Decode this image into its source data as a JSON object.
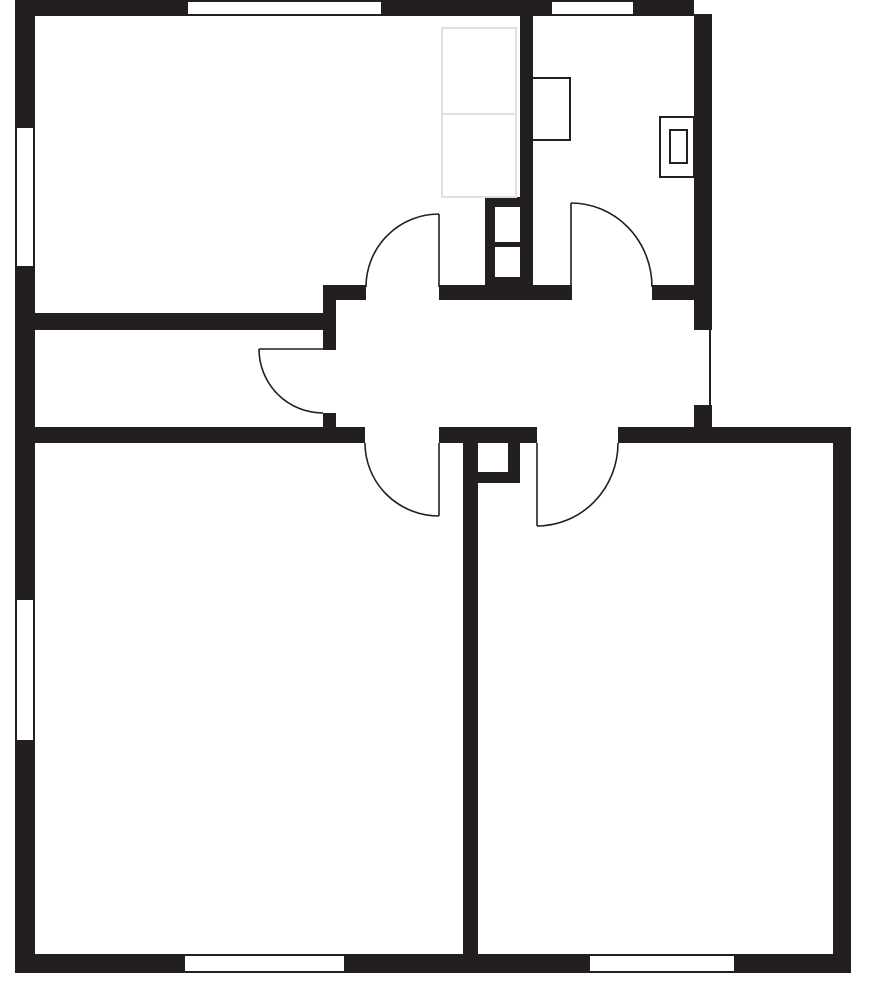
{
  "floor_plan": {
    "canvas": {
      "width": 888,
      "height": 1004,
      "background": "#ffffff"
    },
    "colors": {
      "wall": "#231f20",
      "line": "#231f20",
      "faint_furniture": "#e0e0e0",
      "floor": "#ffffff"
    },
    "walls": [
      {
        "name": "exterior-top-wall-left",
        "x": 15,
        "y": 0,
        "w": 173,
        "h": 16
      },
      {
        "name": "exterior-top-wall-middle",
        "x": 381,
        "y": 0,
        "w": 171,
        "h": 16
      },
      {
        "name": "exterior-top-wall-right",
        "x": 633,
        "y": 0,
        "w": 61,
        "h": 16
      },
      {
        "name": "exterior-left-wall-upper",
        "x": 15,
        "y": 0,
        "w": 20,
        "h": 128
      },
      {
        "name": "exterior-left-wall-middle",
        "x": 15,
        "y": 266,
        "w": 20,
        "h": 334
      },
      {
        "name": "exterior-left-wall-lower",
        "x": 15,
        "y": 740,
        "w": 20,
        "h": 233
      },
      {
        "name": "exterior-bottom-wall-left",
        "x": 15,
        "y": 954,
        "w": 170,
        "h": 19
      },
      {
        "name": "exterior-bottom-wall-middle",
        "x": 344,
        "y": 954,
        "w": 246,
        "h": 19
      },
      {
        "name": "exterior-bottom-wall-right",
        "x": 734,
        "y": 954,
        "w": 117,
        "h": 19
      },
      {
        "name": "exterior-right-wall-upper",
        "x": 694,
        "y": 14,
        "w": 18,
        "h": 316
      },
      {
        "name": "entry-jamb-lower",
        "x": 694,
        "y": 405,
        "w": 18,
        "h": 22
      },
      {
        "name": "exterior-right-wall-lower",
        "x": 833,
        "y": 443,
        "w": 18,
        "h": 511
      },
      {
        "name": "bottom-right-room-top-wall",
        "x": 618,
        "y": 427,
        "w": 233,
        "h": 16
      },
      {
        "name": "top-rooms-divider-wall",
        "x": 520,
        "y": 0,
        "w": 13,
        "h": 200
      },
      {
        "name": "top-left-room-south-wall",
        "x": 35,
        "y": 313,
        "w": 301,
        "h": 17
      },
      {
        "name": "closet-east-wall",
        "x": 323,
        "y": 285,
        "w": 13,
        "h": 65
      },
      {
        "name": "closet-east-wall-stub",
        "x": 323,
        "y": 413,
        "w": 13,
        "h": 14
      },
      {
        "name": "hall-north-wall-west-stub",
        "x": 323,
        "y": 285,
        "w": 43,
        "h": 15
      },
      {
        "name": "hall-north-wall-middle",
        "x": 439,
        "y": 285,
        "w": 133,
        "h": 15
      },
      {
        "name": "hall-north-wall-east",
        "x": 652,
        "y": 285,
        "w": 42,
        "h": 15
      },
      {
        "name": "hall-south-wall-west",
        "x": 15,
        "y": 427,
        "w": 350,
        "h": 16
      },
      {
        "name": "hall-south-wall-middle",
        "x": 439,
        "y": 427,
        "w": 98,
        "h": 16
      },
      {
        "name": "bottom-rooms-divider-wall",
        "x": 463,
        "y": 443,
        "w": 15,
        "h": 511
      },
      {
        "name": "upper-shaft-block",
        "x": 485,
        "y": 197,
        "w": 48,
        "h": 103
      },
      {
        "name": "lower-shaft-east-bar",
        "x": 508,
        "y": 443,
        "w": 12,
        "h": 40
      },
      {
        "name": "lower-shaft-south-bar",
        "x": 478,
        "y": 472,
        "w": 42,
        "h": 11
      }
    ],
    "shaft_openings": [
      {
        "name": "upper-shaft-duct-1",
        "x": 495,
        "y": 207,
        "w": 25,
        "h": 35
      },
      {
        "name": "upper-shaft-duct-2",
        "x": 495,
        "y": 247,
        "w": 25,
        "h": 30
      },
      {
        "name": "lower-shaft-duct",
        "x": 478,
        "y": 443,
        "w": 30,
        "h": 29
      }
    ],
    "windows": [
      {
        "name": "window-top-left-room",
        "x": 188,
        "y": 0,
        "w": 193,
        "h": 16,
        "dir": "h"
      },
      {
        "name": "window-top-right-room",
        "x": 552,
        "y": 0,
        "w": 81,
        "h": 16,
        "dir": "h"
      },
      {
        "name": "window-left-wall-upper",
        "x": 15,
        "y": 128,
        "w": 20,
        "h": 138,
        "dir": "v"
      },
      {
        "name": "window-left-wall-lower",
        "x": 15,
        "y": 600,
        "w": 20,
        "h": 140,
        "dir": "v"
      },
      {
        "name": "window-bottom-left-room",
        "x": 185,
        "y": 954,
        "w": 159,
        "h": 19,
        "dir": "h"
      },
      {
        "name": "window-bottom-right-room",
        "x": 590,
        "y": 954,
        "w": 144,
        "h": 19,
        "dir": "h"
      }
    ],
    "entry_lines": [
      {
        "name": "entry-opening-threshold-line",
        "x1": 710,
        "y1": 330,
        "x2": 710,
        "y2": 405,
        "width": 2
      }
    ],
    "fixtures": [
      {
        "name": "kitchen-appliance-counter",
        "x": 532,
        "y": 78,
        "w": 38,
        "h": 62,
        "stroke": 2
      },
      {
        "name": "kitchen-sink-outer",
        "x": 660,
        "y": 117,
        "w": 34,
        "h": 60,
        "stroke": 2
      },
      {
        "name": "kitchen-sink-basin",
        "x": 670,
        "y": 130,
        "w": 17,
        "h": 33,
        "stroke": 2
      }
    ],
    "faint_furniture": [
      {
        "name": "wardrobe-upper-section",
        "x": 442,
        "y": 28,
        "w": 74,
        "h": 86
      },
      {
        "name": "wardrobe-lower-section",
        "x": 442,
        "y": 114,
        "w": 74,
        "h": 83
      }
    ],
    "doors": [
      {
        "name": "door-top-left-room",
        "hinge": [
          439,
          287
        ],
        "leaf": [
          439,
          214
        ],
        "frame": [
          366,
          287
        ]
      },
      {
        "name": "door-top-right-room",
        "hinge": [
          571,
          287
        ],
        "leaf": [
          571,
          203
        ],
        "frame": [
          652,
          287
        ]
      },
      {
        "name": "door-closet",
        "hinge": [
          323,
          349
        ],
        "leaf": [
          259,
          349
        ],
        "frame": [
          323,
          413
        ]
      },
      {
        "name": "door-bottom-left-room",
        "hinge": [
          439,
          443
        ],
        "leaf": [
          439,
          516
        ],
        "frame": [
          365,
          443
        ]
      },
      {
        "name": "door-bottom-right-room",
        "hinge": [
          537,
          443
        ],
        "leaf": [
          537,
          526
        ],
        "frame": [
          618,
          443
        ]
      }
    ],
    "door_stroke_width": 1.6,
    "window_line_width": 2
  }
}
